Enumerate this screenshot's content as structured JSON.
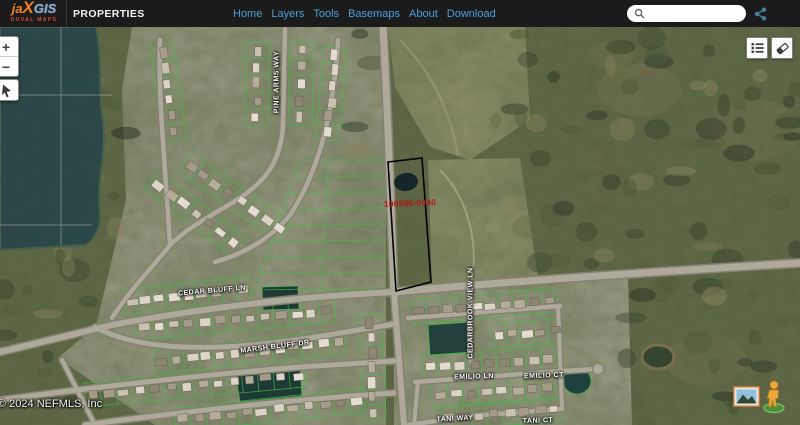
{
  "header": {
    "logo": {
      "part1": "ja",
      "part2": "X",
      "part3": "GIS",
      "subtitle": "DUVAL MAPS"
    },
    "app_title": "PROPERTIES",
    "nav": [
      {
        "label": "Home"
      },
      {
        "label": "Layers"
      },
      {
        "label": "Tools"
      },
      {
        "label": "Basemaps"
      },
      {
        "label": "About"
      },
      {
        "label": "Download"
      }
    ],
    "search": {
      "placeholder": "",
      "value": ""
    }
  },
  "map": {
    "parcel": {
      "id_label": "106586-0040"
    },
    "street_labels": [
      {
        "text": "PINE ARMS WAY"
      },
      {
        "text": "CEDAR BLUFF LN"
      },
      {
        "text": "MARSH BLUFF DR"
      },
      {
        "text": "CEDARBROOK VIEW LN"
      },
      {
        "text": "EMILIO LN"
      },
      {
        "text": "EMILIO CT"
      },
      {
        "text": "TANI WAY"
      },
      {
        "text": "TANI CT"
      }
    ],
    "attribution": "© 2024 NEFMLS, Inc",
    "controls": {
      "zoom_in_label": "+",
      "zoom_out_label": "−"
    },
    "icons": {
      "search": "magnifier",
      "share": "share-nodes",
      "legend": "layer-list",
      "eraser": "eraser",
      "pointer": "cursor-arrow",
      "basemap_toggle": "photo-thumbnail",
      "street_view": "pegman"
    }
  },
  "colors": {
    "header_bg": "#1b1b1b",
    "nav_link": "#4d9fd6",
    "logo_orange": "#f08224",
    "logo_subtitle_red": "#e04a33",
    "parcel_label_red": "#b51616",
    "lot_line_green": "#44b94a",
    "water": "#2b4748"
  }
}
